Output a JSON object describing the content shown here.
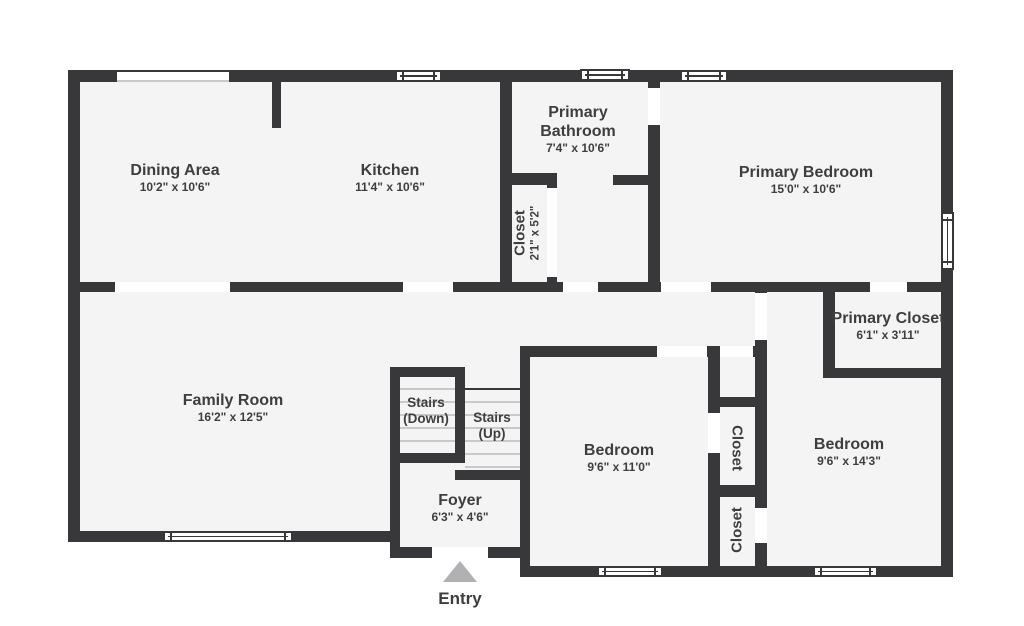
{
  "title": "Floor plan",
  "colors": {
    "wall": "#38383a",
    "floor": "#f4f4f5",
    "opening": "#ffffff",
    "stair_tread": "#c9c9c9",
    "entry_arrow": "#b1b1b3",
    "text": "#3e3e40"
  },
  "rooms": {
    "dining": {
      "name": "Dining Area",
      "dims": "10'2\" x 10'6\""
    },
    "kitchen": {
      "name": "Kitchen",
      "dims": "11'4\" x 10'6\""
    },
    "primary_bathroom": {
      "name": "Primary Bathroom",
      "dims": "7'4\" x 10'6\""
    },
    "primary_bedroom": {
      "name": "Primary Bedroom",
      "dims": "15'0\" x 10'6\""
    },
    "hall_closet": {
      "name": "Closet",
      "dims": "2'1\" x 5'2\""
    },
    "primary_closet": {
      "name": "Primary Closet",
      "dims": "6'1\" x 3'11\""
    },
    "family_room": {
      "name": "Family Room",
      "dims": "16'2\" x 12'5\""
    },
    "stairs_down": {
      "label": "Stairs (Down)"
    },
    "stairs_up": {
      "label": "Stairs (Up)"
    },
    "bedroom_middle": {
      "name": "Bedroom",
      "dims": "9'6\" x 11'0\""
    },
    "closet_upper": {
      "name": "Closet"
    },
    "closet_lower": {
      "name": "Closet"
    },
    "bedroom_right": {
      "name": "Bedroom",
      "dims": "9'6\" x 14'3\""
    },
    "foyer": {
      "name": "Foyer",
      "dims": "6'3\" x 4'6\""
    },
    "entry": {
      "label": "Entry"
    }
  }
}
